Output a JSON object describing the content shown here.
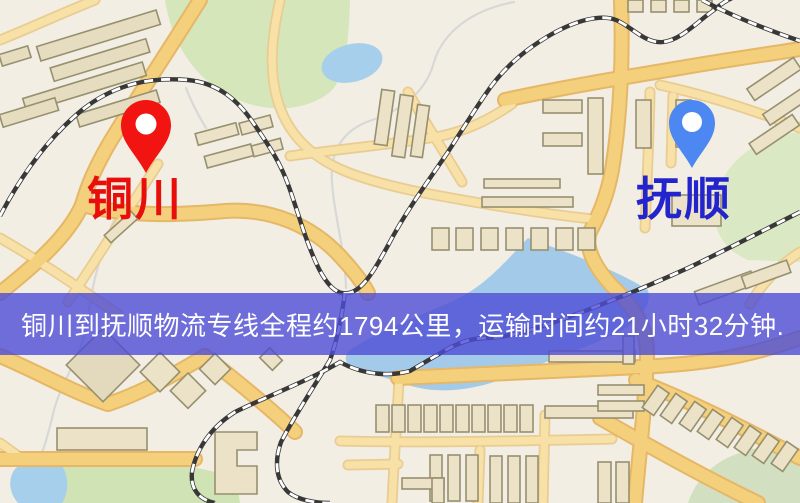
{
  "banner": {
    "text": "铜川到抚顺物流专线全程约1794公里，运输时间约21小时32分钟.",
    "background_color": "rgba(76,76,214,0.8)",
    "text_color": "#ffffff"
  },
  "markers": {
    "origin": {
      "city": "铜川",
      "pin_icon": "map-pin",
      "pin_color": "#f21411",
      "label_color": "#e80f0b"
    },
    "destination": {
      "city": "抚顺",
      "pin_icon": "map-pin",
      "pin_color": "#4d87f2",
      "label_color": "#2424cd"
    }
  },
  "map": {
    "background_color": "#f2eee3",
    "road_color": "#f5d07c",
    "minor_road_color": "#f8e1a6",
    "park_color": "#d5e6ba",
    "water_color": "#a6cfec",
    "railway_color": "#383838",
    "building_color": "#ebe2c8"
  }
}
